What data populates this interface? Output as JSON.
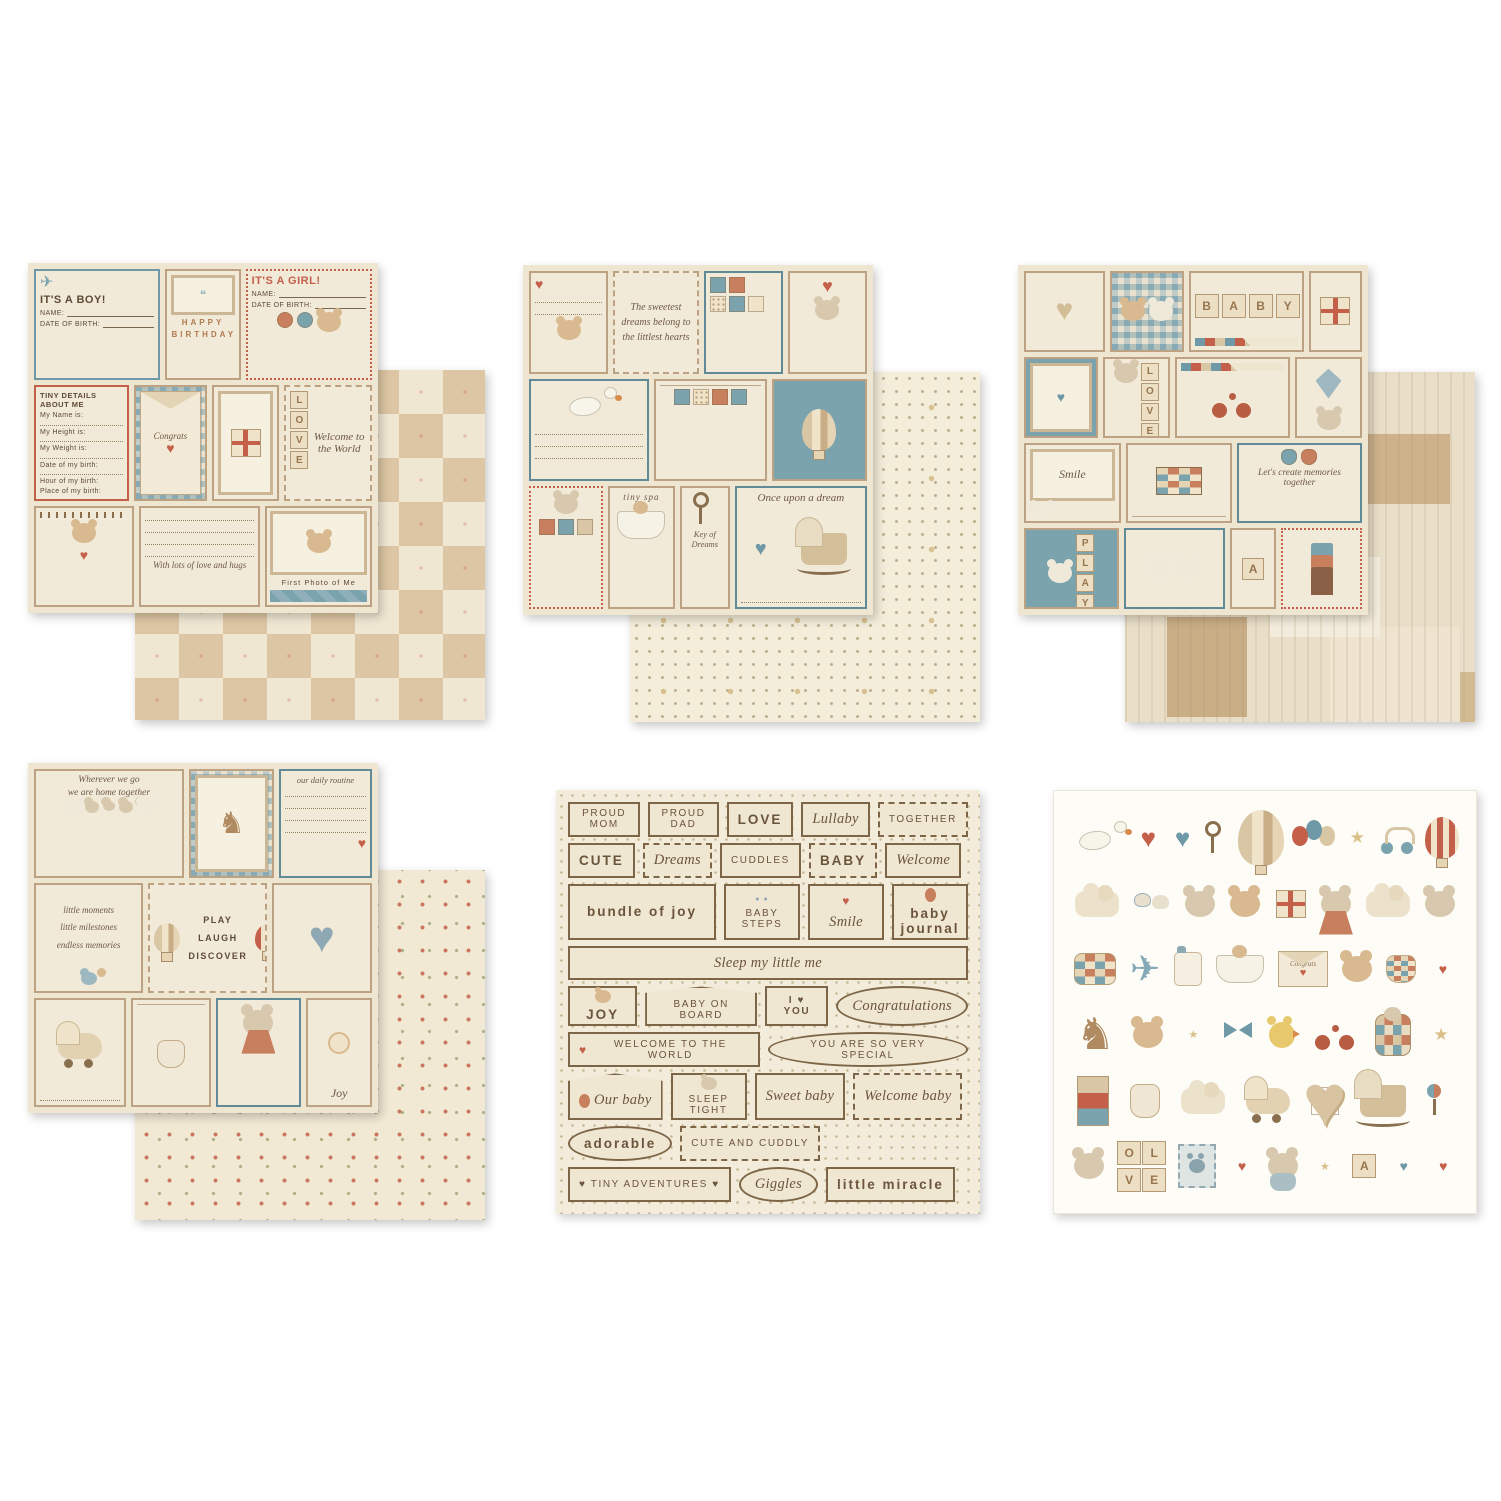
{
  "palette": {
    "background": "#ffffff",
    "cream": "#efe6d2",
    "kraft": "#c2a784",
    "blue": "#6f99a6",
    "terracotta": "#c4604a",
    "brown": "#5d4a36"
  },
  "sheet1": {
    "front": {
      "boy_title": "IT'S A BOY!",
      "boy_name_label": "NAME:",
      "boy_dob_label": "DATE OF BIRTH:",
      "banner_line1": "HAPPY",
      "banner_line2": "BIRTHDAY",
      "girl_title": "IT'S A GIRL!",
      "girl_name_label": "NAME:",
      "girl_dob_label": "DATE OF BIRTH:",
      "details_title": "TINY DETAILS ABOUT ME",
      "details_lines": [
        "My Name is:",
        "My Height is:",
        "My Weight is:",
        "Date of my birth:",
        "Hour of my birth:",
        "Place of my birth:"
      ],
      "envelope_word": "Congrats",
      "love_letters": [
        "L",
        "O",
        "V",
        "E"
      ],
      "welcome_script": "Welcome to the World",
      "wish_script": "With lots of love and hugs",
      "first_photo_caption": "First Photo of Me"
    }
  },
  "sheet2": {
    "front": {
      "dreams_note": "The sweetest dreams belong to the littlest hearts",
      "tiny_spa": "tiny spa",
      "once_upon": "Once upon a dream",
      "key_of_dreams": "Key of Dreams"
    }
  },
  "sheet3": {
    "front": {
      "baby_letters": [
        "B",
        "A",
        "B",
        "Y"
      ],
      "love_letters": [
        "L",
        "O",
        "V",
        "E"
      ],
      "smile": "Smile",
      "memories": "Let's create memories together",
      "play_letters": [
        "P",
        "L",
        "A",
        "Y"
      ],
      "a_letter": "A"
    }
  },
  "sheet4": {
    "front": {
      "home_script_line1": "Wherever we go",
      "home_script_line2": "we are home together",
      "routine_title": "our daily routine",
      "moments_lines": [
        "little moments",
        "little milestones",
        "endless memories"
      ],
      "play_laugh_discover": [
        "PLAY",
        "LAUGH",
        "DISCOVER"
      ],
      "joy": "Joy"
    }
  },
  "sheet5": {
    "rows": [
      [
        {
          "t": "PROUD MOM",
          "k": "plain"
        },
        {
          "t": "PROUD DAD",
          "k": "plain"
        },
        {
          "t": "LOVE",
          "k": "bold"
        },
        {
          "t": "Lullaby",
          "k": "script"
        },
        {
          "t": "TOGETHER",
          "k": "plain dashed"
        }
      ],
      [
        {
          "t": "CUTE",
          "k": "bold"
        },
        {
          "t": "Dreams",
          "k": "script dashed"
        },
        {
          "t": "CUDDLES",
          "k": "plain"
        },
        {
          "t": "BABY",
          "k": "bold dashed"
        },
        {
          "t": "Welcome",
          "k": "script"
        }
      ],
      [
        {
          "t": "bundle of joy",
          "k": "bold wide"
        },
        {
          "t": "BABY STEPS",
          "k": "square plain",
          "icon": "booties"
        },
        {
          "t": "Smile",
          "k": "square script",
          "icon": "heart"
        },
        {
          "t": "baby journal",
          "k": "square bold",
          "icon": "balloon"
        }
      ],
      [
        {
          "t": "Sleep my little me",
          "k": "script wide"
        }
      ],
      [
        {
          "t": "JOY",
          "k": "square bold",
          "icon": "teddy"
        },
        {
          "t": "BABY ON BOARD",
          "k": "tag plain"
        },
        {
          "t": "I ♥ YOU",
          "k": "plain bold"
        },
        {
          "t": "Congratulations",
          "k": "oval script"
        }
      ],
      [
        {
          "t": "WELCOME TO THE WORLD",
          "k": "plain",
          "icon": "heart"
        },
        {
          "t": "YOU ARE SO VERY SPECIAL",
          "k": "oval plain"
        }
      ],
      [
        {
          "t": "Our baby",
          "k": "tag script",
          "icon": "balloon"
        },
        {
          "t": "SLEEP TIGHT",
          "k": "square plain",
          "icon": "mouse"
        },
        {
          "t": "Sweet baby",
          "k": "script"
        },
        {
          "t": "Welcome baby",
          "k": "script dashed"
        }
      ],
      [
        {
          "t": "adorable",
          "k": "oval bold"
        },
        {
          "t": "CUTE AND CUDDLY",
          "k": "plain dashed"
        }
      ],
      [
        {
          "t": "♥ TINY ADVENTURES ♥",
          "k": "plain"
        },
        {
          "t": "Giggles",
          "k": "oval script"
        },
        {
          "t": "little miracle",
          "k": "bold"
        }
      ]
    ]
  },
  "sheet6": {
    "block_letters": [
      "O",
      "L",
      "V",
      "E"
    ],
    "a_letter": "A",
    "envelope_word": "Congrats",
    "rows": [
      [
        {
          "n": "stork-icon",
          "c": "m-stork"
        },
        {
          "n": "red-heart-icon",
          "c": "m-heart"
        },
        {
          "n": "plaid-heart-icon",
          "c": "m-heart plaid"
        },
        {
          "n": "key-icon",
          "c": "m-key"
        },
        {
          "n": "patchwork-hot-air-balloon-icon",
          "c": "m-balloon big"
        },
        {
          "n": "balloon-bunch-icon",
          "c": "m-balloons"
        },
        {
          "n": "star-icon",
          "c": "m-star"
        },
        {
          "n": "toy-scooter-icon",
          "c": "m-scooter"
        },
        {
          "n": "striped-hot-air-balloon-icon",
          "c": "m-balloon stripe"
        }
      ],
      [
        {
          "n": "cloud-icon",
          "c": "m-cloud"
        },
        {
          "n": "baby-booties-icon",
          "c": "m-booties"
        },
        {
          "n": "little-mouse-icon",
          "c": "m-animal mouse"
        },
        {
          "n": "teddy-with-balloons-icon",
          "c": "m-animal"
        },
        {
          "n": "gift-box-icon",
          "c": "m-gift"
        },
        {
          "n": "mother-mouse-with-baby-icon",
          "c": "m-animal mouse mom"
        },
        {
          "n": "cloud-icon",
          "c": "m-cloud"
        },
        {
          "n": "mouse-head-icon",
          "c": "m-animal mouse"
        }
      ],
      [
        {
          "n": "patchwork-pillow-icon",
          "c": "m-pillow"
        },
        {
          "n": "airplane-with-teddy-icon",
          "c": "m-plane"
        },
        {
          "n": "baby-bottle-icon",
          "c": "m-bottle"
        },
        {
          "n": "teddy-in-bathtub-icon",
          "c": "m-bath"
        },
        {
          "n": "congrats-envelope-icon",
          "c": "m-envelope"
        },
        {
          "n": "teddy-bear-icon",
          "c": "m-animal"
        },
        {
          "n": "baby-bloomers-icon",
          "c": "m-onesie short"
        },
        {
          "n": "small-heart-icon",
          "c": "m-heart small"
        }
      ],
      [
        {
          "n": "rocking-horse-icon",
          "c": "m-horse"
        },
        {
          "n": "teddy-with-nightcap-icon",
          "c": "m-animal"
        },
        {
          "n": "star-icon",
          "c": "m-star small"
        },
        {
          "n": "blue-bow-icon",
          "c": "m-bow"
        },
        {
          "n": "duck-icon",
          "c": "m-animal duck"
        },
        {
          "n": "tricycle-icon",
          "c": "m-trike"
        },
        {
          "n": "mouse-in-quilt-icon",
          "c": "m-quilt"
        },
        {
          "n": "star-icon",
          "c": "m-star"
        }
      ],
      [
        {
          "n": "gift-stack-icon",
          "c": "m-gifts"
        },
        {
          "n": "baby-onesie-icon",
          "c": "m-onesie"
        },
        {
          "n": "cloud-icon",
          "c": "m-cloud"
        },
        {
          "n": "pram-with-teddy-icon",
          "c": "m-pram"
        },
        {
          "n": "large-patchwork-heart-icon",
          "c": "m-heart patch big"
        },
        {
          "n": "cradle-icon",
          "c": "m-cradle"
        },
        {
          "n": "rattle-icon",
          "c": "m-rattle"
        }
      ],
      [
        {
          "n": "mouse-with-blocks-icon",
          "c": "m-animal mouse"
        },
        {
          "n": "letter-blocks-love",
          "c": "m-blocks2"
        },
        {
          "n": "teddy-stamp-icon",
          "c": "m-stamp"
        },
        {
          "n": "red-heart-icon",
          "c": "m-heart small"
        },
        {
          "n": "mouse-in-bathrobe-icon",
          "c": "m-animal mouse body"
        },
        {
          "n": "star-icon",
          "c": "m-star small"
        },
        {
          "n": "letter-block-a",
          "c": "m-block1"
        },
        {
          "n": "plaid-heart-icon",
          "c": "m-heart plaid small"
        },
        {
          "n": "red-heart-icon",
          "c": "m-heart small"
        }
      ]
    ]
  }
}
